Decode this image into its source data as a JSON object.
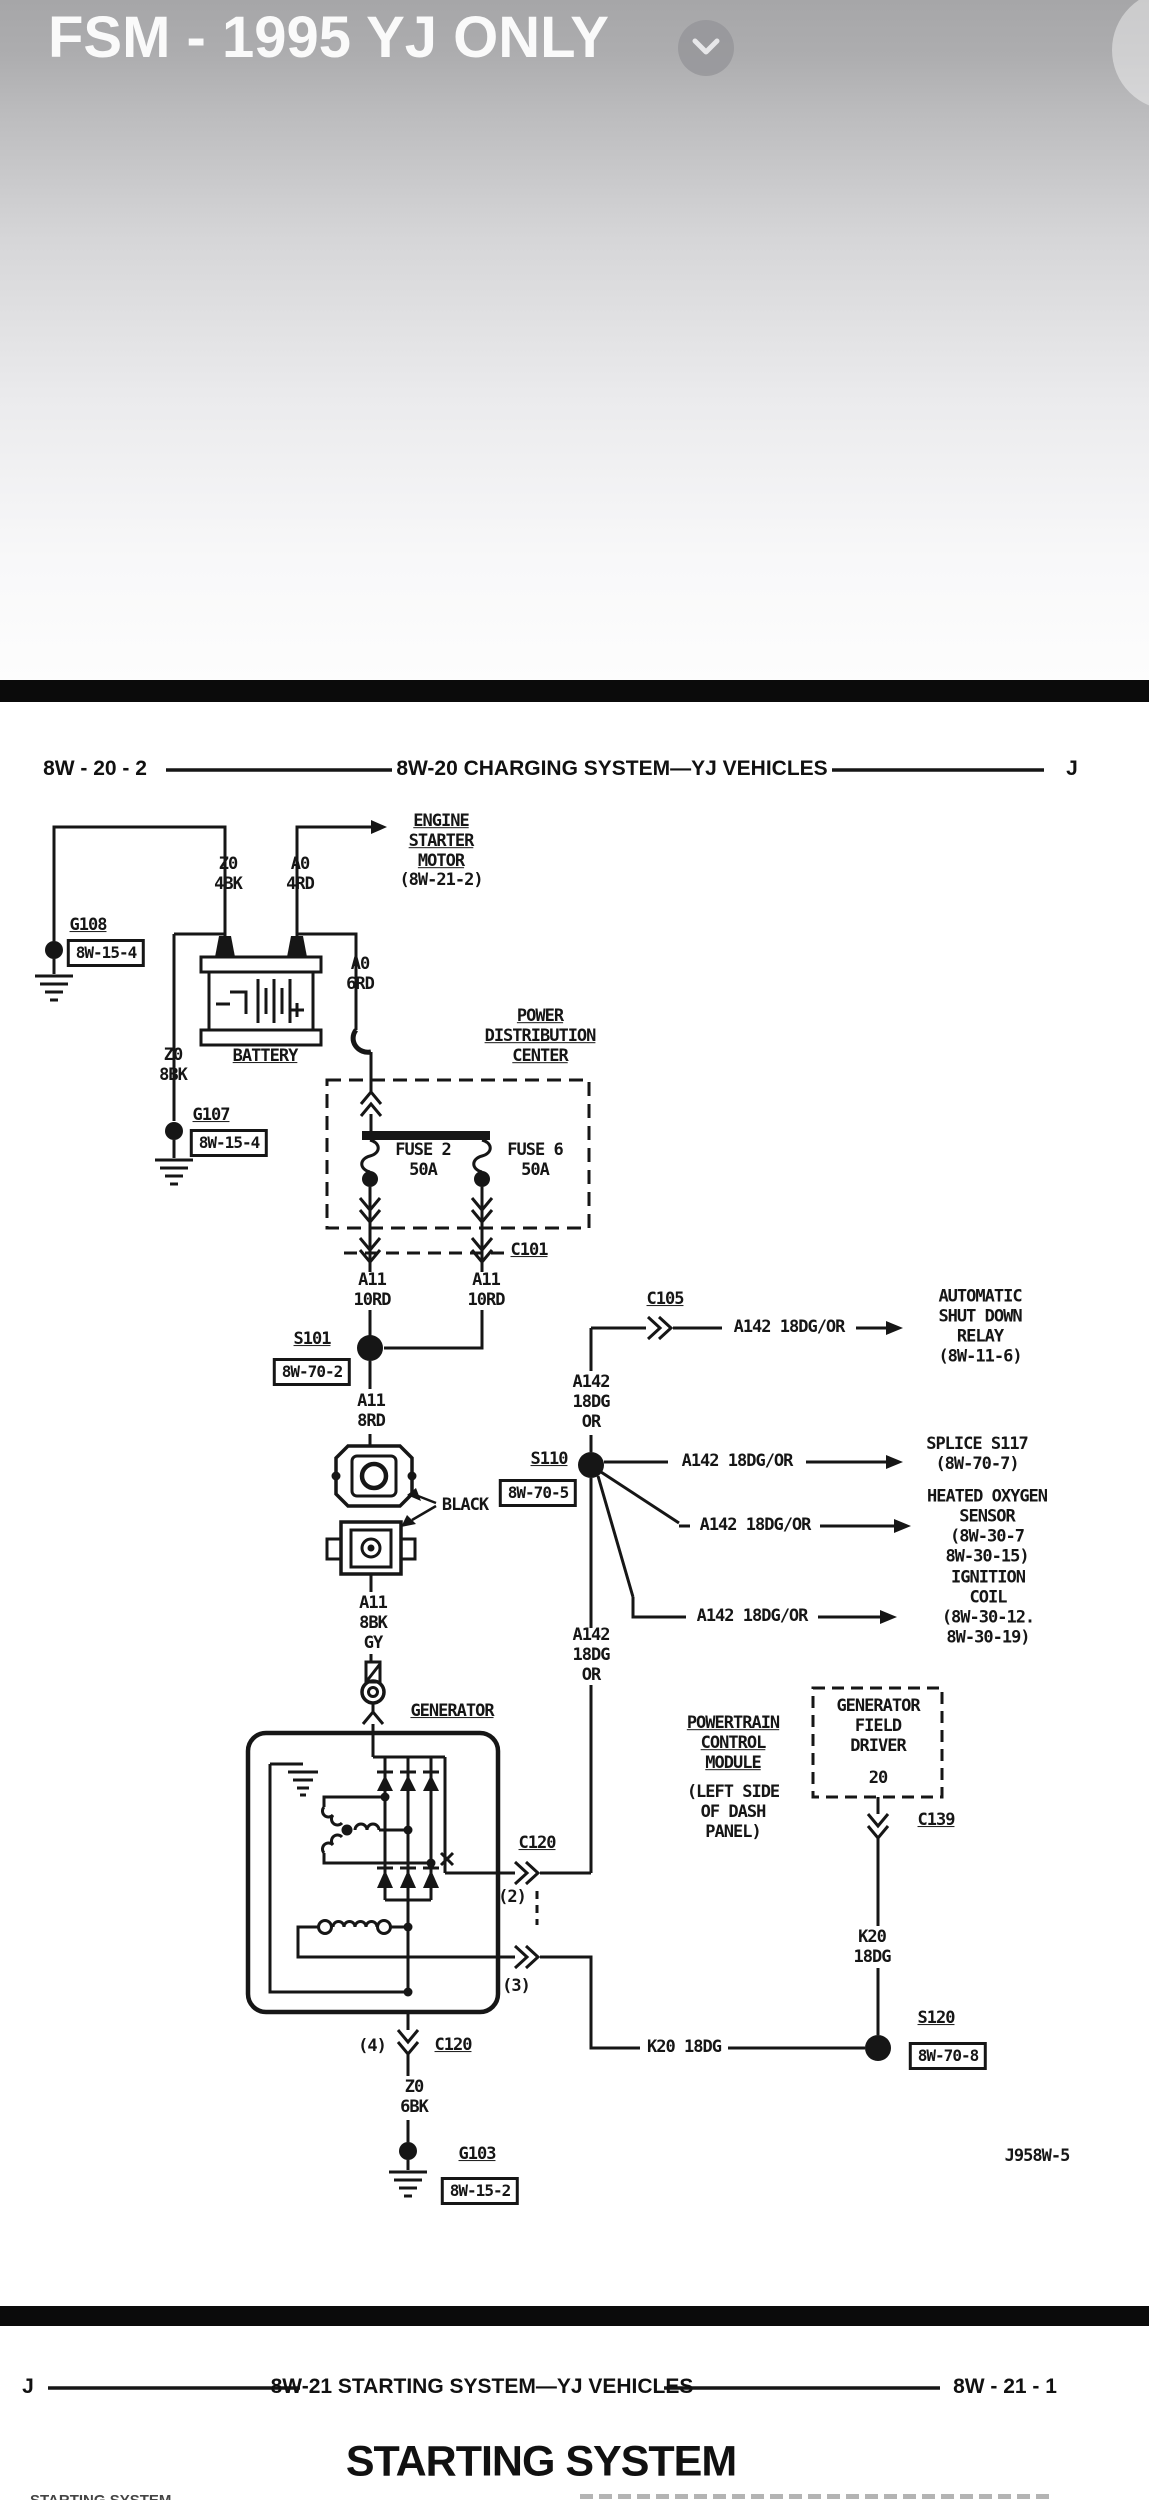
{
  "colors": {
    "ink": "#161616",
    "divider_bar": "#0b0b0b",
    "chrome_top": "#a6a6a8",
    "title_text": "#fafafa",
    "page": "#ffffff"
  },
  "header": {
    "title": "FSM - 1995 YJ ONLY"
  },
  "page_header": {
    "left": "8W - 20 - 2",
    "center": "8W-20 CHARGING SYSTEM—YJ VEHICLES",
    "right": "J"
  },
  "diagram": {
    "figure_code": "J958W-5",
    "components": {
      "battery": "BATTERY",
      "generator": "GENERATOR",
      "pdc": "POWER\nDISTRIBUTION\nCENTER",
      "fuse2": "FUSE 2\n50A",
      "fuse6": "FUSE 6\n50A",
      "pcm_name": "POWERTRAIN\nCONTROL\nMODULE",
      "pcm_loc": "(LEFT SIDE\nOF DASH\nPANEL)",
      "gfd_name": "GENERATOR\nFIELD\nDRIVER",
      "gfd_pin": "20"
    },
    "destinations": {
      "starter_name": "ENGINE\nSTARTER\nMOTOR",
      "starter_ref": "(8W-21-2)",
      "asd": "AUTOMATIC\nSHUT DOWN\nRELAY\n(8W-11-6)",
      "s117": "SPLICE S117\n(8W-70-7)",
      "o2": "HEATED OXYGEN\nSENSOR\n(8W-30-7\n8W-30-15)",
      "coil": "IGNITION\nCOIL\n(8W-30-12.\n8W-30-19)"
    },
    "grounds": {
      "g108": "G108",
      "g108_ref": "8W-15-4",
      "g107": "G107",
      "g107_ref": "8W-15-4",
      "g103": "G103",
      "g103_ref": "8W-15-2"
    },
    "splices": {
      "s101": "S101",
      "s101_ref": "8W-70-2",
      "s110": "S110",
      "s110_ref": "8W-70-5",
      "s120": "S120",
      "s120_ref": "8W-70-8"
    },
    "connectors": {
      "c101": "C101",
      "c105": "C105",
      "c120": "C120",
      "c139": "C139",
      "pin2": "(2)",
      "pin3": "(3)",
      "pin4": "(4)"
    },
    "wires": {
      "z0_4bk": "Z0\n4BK",
      "a0_4rd": "A0\n4RD",
      "a0_6rd": "A0\n6RD",
      "z0_8bk": "Z0\n8BK",
      "z0_6bk": "Z0\n6BK",
      "a11_10rd": "A11\n10RD",
      "a11_8rd": "A11\n8RD",
      "a11_8bk_gy": "A11\n8BK\nGY",
      "a142_stack": "A142\n18DG\nOR",
      "a142_inline": "A142 18DG/OR",
      "k20_stack": "K20\n18DG",
      "k20_inline": "K20 18DG",
      "black": "BLACK"
    }
  },
  "footer": {
    "left": "J",
    "center": "8W-21 STARTING SYSTEM—YJ VEHICLES",
    "right": "8W - 21 - 1",
    "heading": "STARTING SYSTEM",
    "cut_left": "STARTING SYSTEM"
  }
}
